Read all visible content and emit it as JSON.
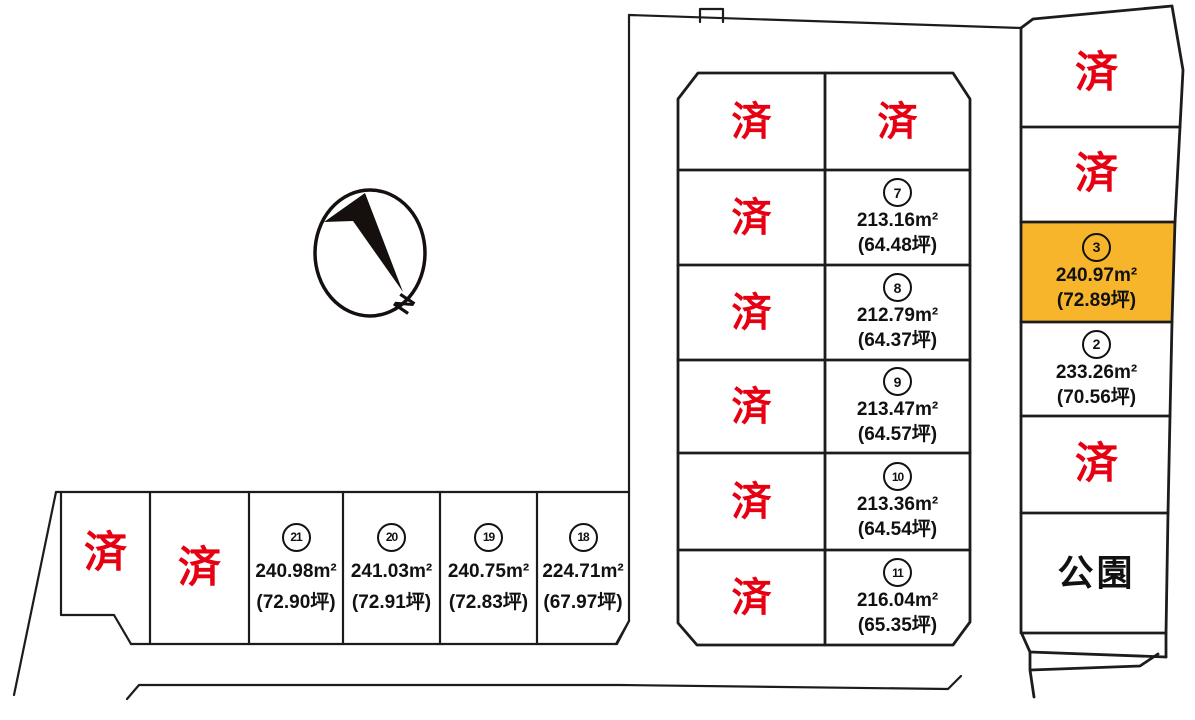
{
  "colors": {
    "background": "#ffffff",
    "line": "#1c1c1c",
    "sold_text": "#e60012",
    "highlight_fill": "#f7b52c",
    "lot_text": "#111111"
  },
  "compass": {
    "north_label": "N"
  },
  "lots": {
    "center_left": [
      "済",
      "済",
      "済",
      "済",
      "済",
      "済"
    ],
    "center_right": [
      {
        "status": "済"
      },
      {
        "number": "7",
        "area": "213.16m²",
        "tsubo": "(64.48坪)"
      },
      {
        "number": "8",
        "area": "212.79m²",
        "tsubo": "(64.37坪)"
      },
      {
        "number": "9",
        "area": "213.47m²",
        "tsubo": "(64.57坪)"
      },
      {
        "number": "10",
        "area": "213.36m²",
        "tsubo": "(64.54坪)"
      },
      {
        "number": "11",
        "area": "216.04m²",
        "tsubo": "(65.35坪)"
      }
    ],
    "right": [
      {
        "status": "済"
      },
      {
        "status": "済"
      },
      {
        "number": "3",
        "area": "240.97m²",
        "tsubo": "(72.89坪)",
        "highlighted": true
      },
      {
        "number": "2",
        "area": "233.26m²",
        "tsubo": "(70.56坪)"
      },
      {
        "status": "済"
      },
      {
        "name": "公園"
      }
    ],
    "bottom": [
      {
        "status": "済"
      },
      {
        "status": "済"
      },
      {
        "number": "21",
        "area": "240.98m²",
        "tsubo": "(72.90坪)"
      },
      {
        "number": "20",
        "area": "241.03m²",
        "tsubo": "(72.91坪)"
      },
      {
        "number": "19",
        "area": "240.75m²",
        "tsubo": "(72.83坪)"
      },
      {
        "number": "18",
        "area": "224.71m²",
        "tsubo": "(67.97坪)"
      }
    ]
  }
}
